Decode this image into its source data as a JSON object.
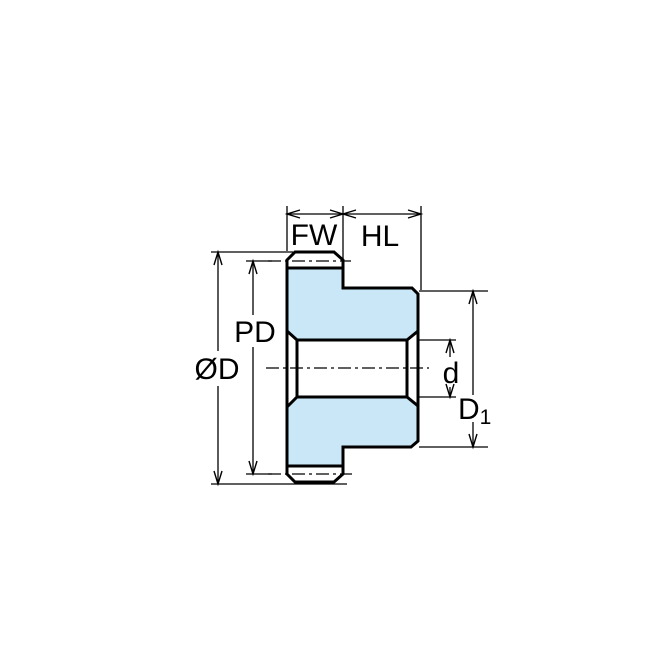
{
  "diagram": {
    "labels": {
      "fw": "FW",
      "hl": "HL",
      "pd": "PD",
      "od": "ØD",
      "bore": "d",
      "hub_main": "D",
      "hub_sub": "1"
    },
    "colors": {
      "background": "#ffffff",
      "body_fill": "#c9e7f7",
      "line": "#000000"
    }
  }
}
